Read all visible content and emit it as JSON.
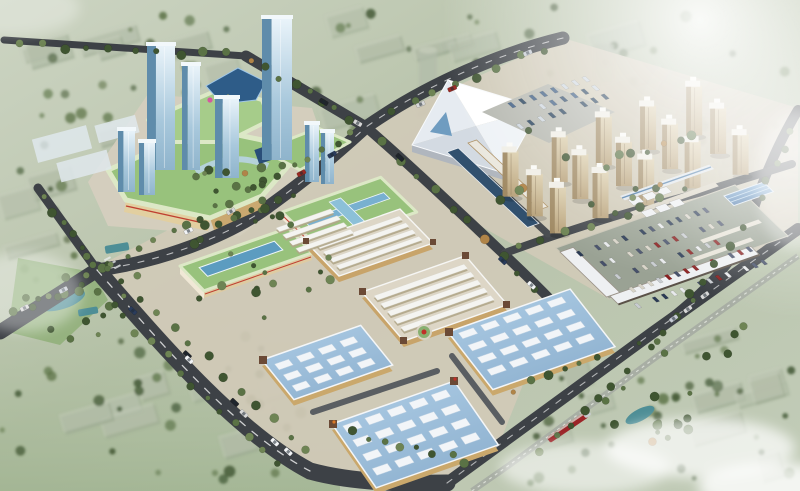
{
  "image_type": "aerial architectural rendering",
  "subject": "master plan rendering of a mixed-use commercial trade center with mall towers, exhibition hall, residential towers, market blocks, blue-roof warehouse halls and parking campus",
  "palette": {
    "bg1": "#ccd4c2",
    "bg2": "#b7c2a9",
    "bg3": "#c2ccb8",
    "ctx-block": "#9caa92",
    "ctx-top": "#c6cdbb",
    "tree1": "#3f5531",
    "tree2": "#5a7245",
    "tree3": "#6e8454",
    "tree-orange": "#b08448",
    "road": "#3d4146",
    "road-edge": "#565a5e",
    "road-line": "#ffffff",
    "ground": "#d2cab8",
    "paving": "#d8d2c2",
    "grass": "#8faf78",
    "green-roof": "#98c27c",
    "green-roof2": "#a6cc8a",
    "roof-edge": "#dce8c6",
    "sky-blue": "#78b0d0",
    "sky-teal": "#5c9cc0",
    "glass-side": "#5f8cab",
    "glass-top": "#f2f8fb",
    "white-roof": "#eef0f2",
    "white-roof-sh": "#c9cfd7",
    "tan-wall": "#c8a46a",
    "cream": "#f0e8d6",
    "red-stripe": "#c04030",
    "blue-roof": "#a3c4de",
    "blue-roof2": "#8fb2d0",
    "skylight": "#f2f5f8",
    "dark-roof": "#31506e",
    "pavilion": "#6b4a36",
    "arch1": "#4f82b8",
    "arch2": "#7fb0dc",
    "res-front1": "#dccfae",
    "res-front2": "#b9a37c",
    "res-side": "#a08a64",
    "res-top": "#f0eee6",
    "lot": "#9aa294",
    "canopy": "#2e5c88",
    "mall-glass": "#2a4e78",
    "rail": "#a8aea4",
    "train": "#9c2428",
    "pond": "#4e8e96",
    "hall-wall": "#b0b6be"
  },
  "zones": [
    {
      "name": "office-tower-cluster",
      "desc": "blue glass high-rise towers on mall podium",
      "count": 8
    },
    {
      "name": "shopping-mall-podium",
      "desc": "curved light-green roofs, dark blue canopy, amber facades"
    },
    {
      "name": "exhibition-hall",
      "desc": "white faceted-roof hall with bus parking lot"
    },
    {
      "name": "residential-district",
      "desc": "grid of beige apartment towers",
      "count": 15
    },
    {
      "name": "market-blocks",
      "desc": "perimeter blocks filled with rows of white gabled stall roofs"
    },
    {
      "name": "green-roof-halls",
      "desc": "two halls with green roofs and blue skylight strips"
    },
    {
      "name": "warehouse-halls",
      "desc": "three halls with light blue roofs and white skylight grids"
    },
    {
      "name": "parking-campus",
      "desc": "surface car park enclosed by white L-shaped buildings and a blue arched warehouse"
    },
    {
      "name": "context-city",
      "desc": "faded grey-green low-rise city blocks with trees"
    },
    {
      "name": "railway-corridor",
      "desc": "rail line with red train, lower right"
    }
  ],
  "effects": {
    "sun_glare": "white radial glare upper right",
    "haze": "cloud haze lower right and left edge"
  },
  "generated": {
    "context": {
      "rot": -16,
      "bw": [
        22,
        60
      ],
      "bh": [
        10,
        26
      ],
      "zones": [
        {
          "x": 10,
          "y": 6,
          "w": 780,
          "h": 158,
          "blocks": 26,
          "trees": 70
        },
        {
          "x": 0,
          "y": 330,
          "w": 310,
          "h": 155,
          "blocks": 9,
          "trees": 34
        },
        {
          "x": 530,
          "y": 335,
          "w": 265,
          "h": 148,
          "blocks": 10,
          "trees": 36
        },
        {
          "x": 0,
          "y": 170,
          "w": 80,
          "h": 110,
          "blocks": 3,
          "trees": 10
        }
      ]
    },
    "tree_lines": [
      [
        5,
        44,
        240,
        56,
        10
      ],
      [
        88,
        285,
        285,
        468,
        14
      ],
      [
        114,
        274,
        315,
        460,
        12
      ],
      [
        118,
        262,
        360,
        131,
        16
      ],
      [
        380,
        118,
        552,
        44,
        8
      ],
      [
        245,
        57,
        358,
        122,
        8
      ],
      [
        374,
        136,
        545,
        294,
        10
      ],
      [
        40,
        192,
        92,
        262,
        6
      ],
      [
        6,
        318,
        88,
        279,
        5
      ],
      [
        795,
        120,
        757,
        208,
        5
      ],
      [
        751,
        219,
        642,
        358,
        8
      ],
      [
        636,
        364,
        532,
        458,
        7
      ],
      [
        506,
        252,
        696,
        187,
        8
      ],
      [
        342,
        432,
        476,
        462,
        8
      ],
      [
        502,
        392,
        608,
        352,
        6
      ],
      [
        200,
        230,
        300,
        196,
        7
      ],
      [
        610,
        160,
        700,
        135,
        6
      ]
    ],
    "tree_clusters": [
      [
        600,
        385,
        90,
        58,
        14
      ],
      [
        22,
        256,
        90,
        86,
        16
      ],
      [
        192,
        160,
        102,
        74,
        18
      ],
      [
        246,
        256,
        92,
        62,
        10
      ],
      [
        496,
        126,
        190,
        92,
        12
      ],
      [
        106,
        238,
        130,
        86,
        8
      ],
      [
        628,
        300,
        120,
        60,
        8
      ]
    ],
    "cars": {
      "colors": [
        "#f2f4f6",
        "#20242a",
        "#9a2a24",
        "#2a3c5c",
        "#c6ccd4",
        "#d8d8d8"
      ],
      "lines": [
        [
          112,
          287,
          298,
          462,
          7
        ],
        [
          142,
          256,
          338,
          152,
          4
        ],
        [
          382,
          118,
          548,
          46,
          3
        ],
        [
          252,
          62,
          356,
          122,
          2
        ],
        [
          12,
          318,
          86,
          280,
          2
        ],
        [
          660,
          330,
          788,
          237,
          3
        ],
        [
          382,
          142,
          536,
          288,
          3
        ]
      ]
    },
    "glass_towers": [
      [
        147,
        45,
        28,
        125
      ],
      [
        182,
        65,
        18,
        105
      ],
      [
        262,
        18,
        30,
        142
      ],
      [
        215,
        98,
        24,
        80
      ],
      [
        118,
        130,
        17,
        62
      ],
      [
        139,
        142,
        16,
        53
      ],
      [
        305,
        124,
        14,
        58
      ],
      [
        321,
        132,
        13,
        52
      ]
    ],
    "lowrises": [
      [
        34,
        132,
        56,
        24
      ],
      [
        58,
        156,
        52,
        20
      ],
      [
        96,
        120,
        42,
        18
      ]
    ],
    "residential": {
      "origin": [
        512,
        196
      ],
      "du": [
        46,
        -15
      ],
      "dv": [
        22,
        19
      ],
      "cols": 5,
      "rows": 3,
      "w": 11,
      "hmin": 40,
      "hmax": 50
    },
    "bus_lot": {
      "origin": [
        497,
        107
      ],
      "du": [
        10.6,
        -3.7
      ],
      "dv": [
        9.5,
        8.8
      ],
      "cols": 9,
      "rows": 3,
      "ul": 3.6,
      "vl": 8.5,
      "colors": [
        "#2c4868",
        "#3a5a80",
        "#243f5a",
        "#cdd6de"
      ],
      "skip": 0.18
    },
    "lot_cars": {
      "origin": [
        576,
        252
      ],
      "du": [
        9,
        -3.1
      ],
      "dv": [
        14.5,
        13
      ],
      "cols": 15,
      "rows": 5,
      "ul": 3.2,
      "vl": 7.5,
      "colors": [
        "#e8eaec",
        "#2a3a55",
        "#8a2020",
        "#c8ccd0",
        "#46506a",
        "#d8d4c8"
      ],
      "skip": 0.3
    },
    "campus_sheds": {
      "origin": [
        628,
        200
      ],
      "du": [
        14,
        -4.9
      ],
      "dv": [
        13,
        12
      ],
      "cols": 3,
      "rows": 2,
      "ul": 11,
      "vl": 9,
      "colors": [
        "#eef0f2"
      ],
      "skip": 0
    },
    "skylights": {
      "f1": {
        "o": [
          274.5,
          364.1
        ],
        "u": [
          0.94,
          -0.33
        ],
        "v": [
          0.58,
          0.72
        ],
        "du": 23,
        "dv": 15,
        "cols": 4,
        "rows": 3,
        "w": 15,
        "h": 8
      },
      "f2": {
        "o": [
          342.6,
          425.9
        ],
        "u": [
          0.94,
          -0.33
        ],
        "v": [
          0.52,
          0.75
        ],
        "du": 23.5,
        "dv": 19,
        "cols": 5,
        "rows": 4,
        "w": 16,
        "h": 9
      },
      "f3": {
        "o": [
          458.3,
          333
        ],
        "u": [
          0.94,
          -0.33
        ],
        "v": [
          0.56,
          0.72
        ],
        "du": 23.5,
        "dv": 17,
        "cols": 5,
        "rows": 4,
        "w": 16,
        "h": 8
      }
    },
    "gables": {
      "d1": {
        "o": [
          316.4,
          245
        ],
        "u": [
          0.94,
          -0.33
        ],
        "v": [
          0.6,
          0.62
        ],
        "w": 88,
        "t": 6,
        "n": 4,
        "dv": 11
      },
      "d2": {
        "o": [
          373.8,
          295.8
        ],
        "u": [
          0.94,
          -0.33
        ],
        "v": [
          0.58,
          0.68
        ],
        "w": 96,
        "t": 6.5,
        "n": 5,
        "dv": 11.5
      },
      "m1": {
        "o": [
          276,
          228
        ],
        "u": [
          0.94,
          -0.33
        ],
        "v": [
          0.6,
          0.62
        ],
        "w": 58,
        "t": 6,
        "n": 4,
        "dv": 11
      }
    }
  }
}
